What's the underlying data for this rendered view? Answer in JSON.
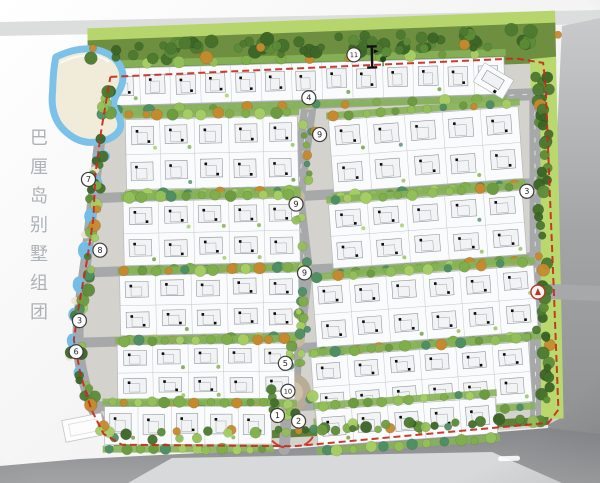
{
  "image_type": "residential-master-plan-site-map",
  "title": {
    "text": "巴厘岛别墅组团"
  },
  "colors": {
    "boundary_red": "#c92a1b",
    "water_blue": "#74bde4",
    "sand": "#f1ecd9",
    "tree_dark": "#4d7a30",
    "tree_light": "#93bf58",
    "accent_orange": "#c68a2e",
    "road_gray": "#a6a8aa",
    "outer_road_dark": "#8a8b8d",
    "outer_road_light": "#d8d9da",
    "villa_white": "#fafbfc",
    "marker_stroke": "#3c3c3c"
  },
  "plan": {
    "markers": [
      {
        "label": "11",
        "x": 358,
        "y": 56
      },
      {
        "label": "4",
        "x": 312,
        "y": 98
      },
      {
        "label": "9",
        "x": 322,
        "y": 135
      },
      {
        "label": "9",
        "x": 297,
        "y": 204
      },
      {
        "label": "9",
        "x": 304,
        "y": 273
      },
      {
        "label": "7",
        "x": 90,
        "y": 175
      },
      {
        "label": "8",
        "x": 100,
        "y": 246
      },
      {
        "label": "3",
        "x": 78,
        "y": 316
      },
      {
        "label": "6",
        "x": 74,
        "y": 347
      },
      {
        "label": "3",
        "x": 528,
        "y": 196
      },
      {
        "label": "5",
        "x": 283,
        "y": 363
      },
      {
        "label": "10",
        "x": 285,
        "y": 391
      },
      {
        "label": "1",
        "x": 274,
        "y": 415
      },
      {
        "label": "2",
        "x": 295,
        "y": 421
      }
    ],
    "entrance_marker": {
      "x": 537,
      "y": 297,
      "icon": "main-entrance-icon"
    },
    "section_symbol": {
      "x": 376,
      "y": 57,
      "icon": "section-cut-icon"
    }
  }
}
